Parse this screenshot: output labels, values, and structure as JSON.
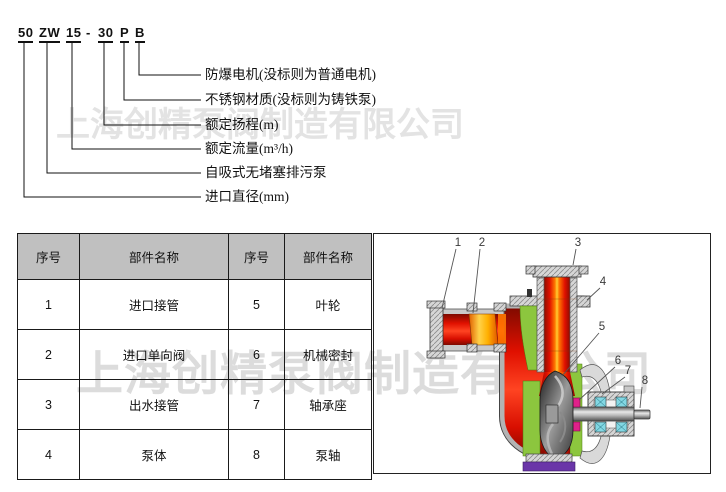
{
  "watermark": {
    "text": "上海创精泵阀制造有限公司",
    "color_top": "#e3e3e3",
    "color_bottom": "#dcdcdc"
  },
  "model_code": {
    "segments": [
      {
        "text": "50"
      },
      {
        "text": "ZW"
      },
      {
        "text": "15"
      },
      {
        "text": "-"
      },
      {
        "text": "30"
      },
      {
        "text": "P"
      },
      {
        "text": "B"
      }
    ],
    "callout_labels": [
      {
        "label": "防爆电机(没标则为普通电机)"
      },
      {
        "label": "不锈钢材质(没标则为铸铁泵)"
      },
      {
        "label": "额定扬程(m)"
      },
      {
        "label": "额定流量(m³/h)"
      },
      {
        "label": "自吸式无堵塞排污泵"
      },
      {
        "label": "进口直径(mm)"
      }
    ]
  },
  "parts_table": {
    "header_bg": "#c0c0c0",
    "headers": [
      "序号",
      "部件名称",
      "序号",
      "部件名称"
    ],
    "rows": [
      [
        "1",
        "进口接管",
        "5",
        "叶轮"
      ],
      [
        "2",
        "进口单向阀",
        "6",
        "机械密封"
      ],
      [
        "3",
        "出水接管",
        "7",
        "轴承座"
      ],
      [
        "4",
        "泵体",
        "8",
        "泵轴"
      ]
    ]
  },
  "diagram": {
    "callouts": [
      "1",
      "2",
      "3",
      "4",
      "5",
      "6",
      "7",
      "8"
    ],
    "colors": {
      "casing_red": "#dd1100",
      "flow_orange": "#ffaa00",
      "chamber_green": "#8cc63e",
      "bearing_cyan": "#82d7e3",
      "seal_magenta": "#e0218a",
      "base_purple": "#6a35a8",
      "metal_gray": "#c9c9c9"
    }
  }
}
